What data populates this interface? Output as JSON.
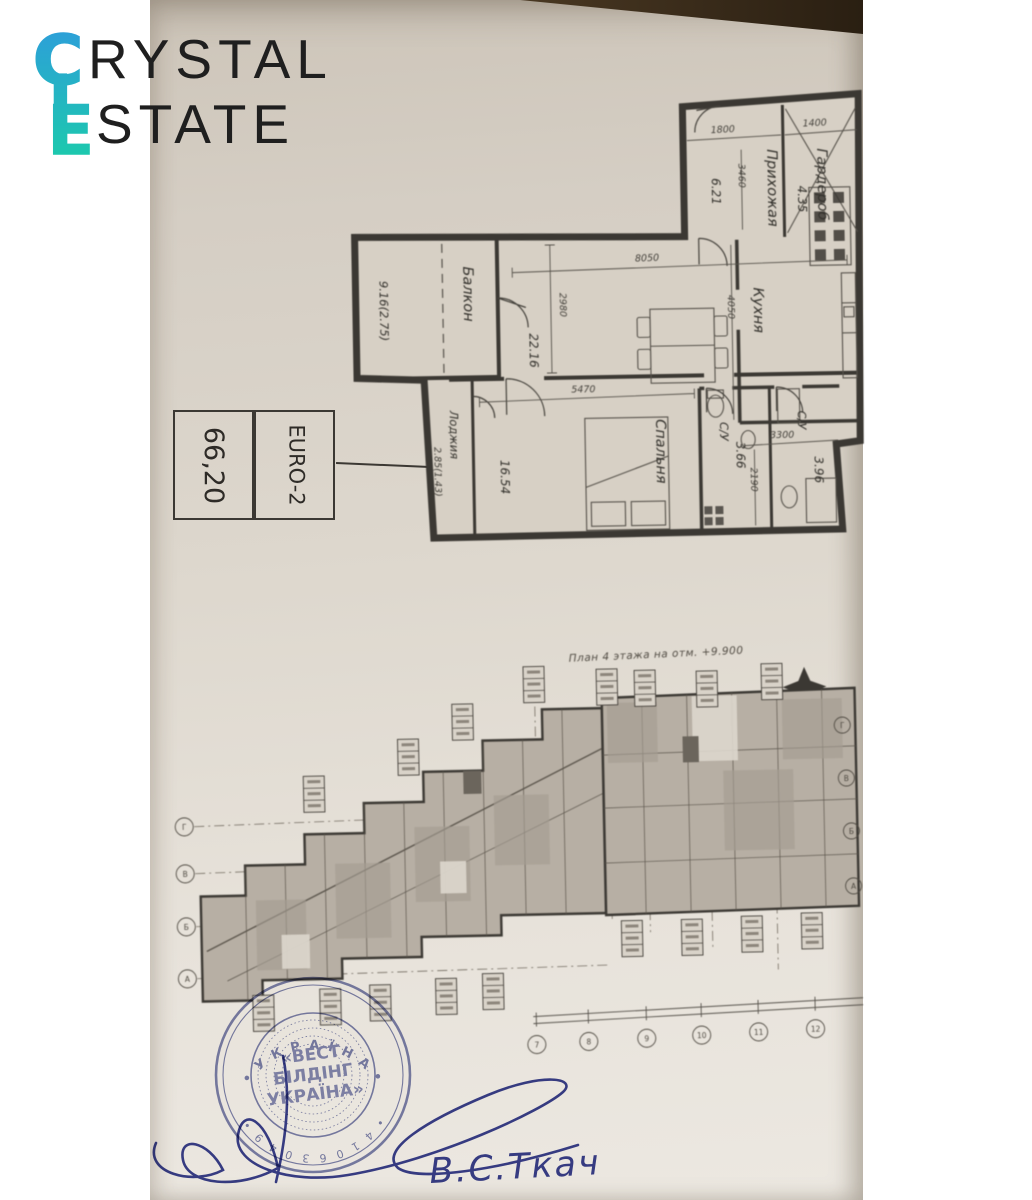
{
  "colors": {
    "paper_top": "#cdc5b9",
    "paper_bot": "#ece8e1",
    "ink": "#3b3833",
    "stamp_blue": "#7077ac",
    "pen_blue": "#3a4193",
    "logo_top": "#2d9fd9",
    "logo_bot": "#1cc9ad",
    "logo_text": "#1f1f1f"
  },
  "logo": {
    "word1_initial": "C",
    "word1_rest": "RYSTAL",
    "word2_initial": "E",
    "word2_rest": "STATE"
  },
  "unit_card": {
    "area": "66,20",
    "unit_type": "EURO-2"
  },
  "flat_plan": {
    "rooms": {
      "balcony": {
        "label": "Балкон",
        "area": "9.16(2.75)"
      },
      "hallway": {
        "label": "Прихожая",
        "area": "6.21"
      },
      "wardrobe": {
        "label": "Гардероб",
        "area": "4.35"
      },
      "living": {
        "area": "22.16"
      },
      "kitchen": {
        "label": "Кухня"
      },
      "bedroom": {
        "label": "Спальня",
        "area": "16.54"
      },
      "loggia": {
        "label": "Лоджия",
        "area": "2.85(1.43)"
      },
      "bath1": {
        "label": "С/У",
        "area": "3.66"
      },
      "bath2": {
        "label": "С/У",
        "area": "3.96"
      }
    },
    "dims": {
      "d1800": "1800",
      "d1400": "1400",
      "d3460": "3460",
      "d8050": "8050",
      "d2980": "2980",
      "d4050": "4050",
      "d5470": "5470",
      "d3300": "3300",
      "d2190": "2190"
    }
  },
  "floor_plan": {
    "title": "План 4 этажа на отм. +9.900",
    "row_axes": [
      "Г",
      "В",
      "Б",
      "А"
    ],
    "col_axes": [
      "7",
      "8",
      "9",
      "10",
      "11",
      "12"
    ]
  },
  "stamp": {
    "center1": "«ВЕСТ",
    "center2": "БІЛДІНГ",
    "center3": "УКРАЇНА»",
    "ring_top": "• У К Р А Ї Н А •",
    "ring_bottom": "• 4 1 0 6 3 0 4 9 •"
  },
  "signature": {
    "name": "В.С.Ткач"
  }
}
